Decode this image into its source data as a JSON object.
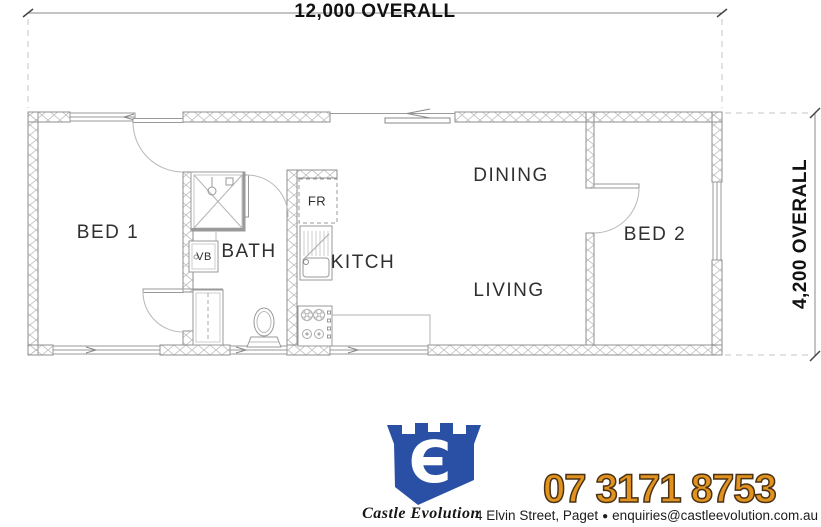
{
  "dimensions": {
    "width_label": "12,000 OVERALL",
    "height_label": "4,200 OVERALL"
  },
  "rooms": {
    "bed1": "BED 1",
    "bath": "BATH",
    "kitchen": "KITCH",
    "dining": "DINING",
    "living": "LIVING",
    "bed2": "BED 2"
  },
  "fixtures": {
    "fridge": "FR",
    "vanity": "VB"
  },
  "brand": {
    "name": "Castle Evolution",
    "logo_glyph": "Є",
    "phone": "07 3171 8753",
    "address": "4 Elvin Street, Paget",
    "separator": "●",
    "email": "enquiries@castleevolution.com.au"
  },
  "colors": {
    "logo_blue": "#2a50a5",
    "phone_orange": "#e2921f",
    "phone_outline": "#4a3214",
    "wall_line": "#8f8f8f",
    "hatch": "#bdbdbd",
    "label_text": "#2f2f2f"
  },
  "icons": {
    "logo": "castle-tower-shield-with-E",
    "shower": "shower-square-with-x",
    "toilet": "toilet-plan-view",
    "sink": "kitchen-sink-with-drainer",
    "stove": "cooktop-4-burner",
    "fridge": "fridge-dashed-box",
    "doors": "door-swing-arc",
    "windows": "window-double-line",
    "sliding_door": "sliding-door-left-arrow"
  }
}
